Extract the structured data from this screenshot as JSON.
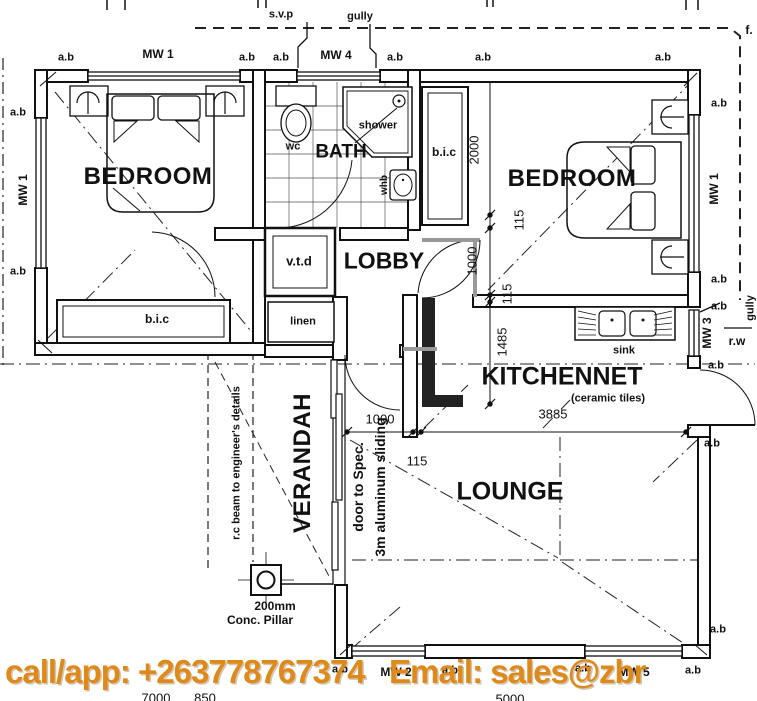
{
  "plan": {
    "rooms": {
      "bedroom_left": "BEDROOM",
      "bedroom_right": "BEDROOM",
      "bath": "BATH",
      "lobby": "LOBBY",
      "kitchennet": "KITCHENNET",
      "kitchennet_note": "(ceramic tiles)",
      "lounge": "LOUNGE",
      "verandah": "VERANDAH"
    },
    "fixtures": {
      "wc": "wc",
      "shower": "shower",
      "whb": "whb",
      "sink": "sink",
      "vtd": "v.t.d",
      "linen": "linen",
      "bic": "b.i.c"
    },
    "windows": {
      "mw1": "MW 1",
      "mw2": "MW 2",
      "mw3": "MW 3",
      "mw4": "MW 4",
      "mw5": "MW 5",
      "ab": "a.b"
    },
    "annotations": {
      "svp": "s.v.p",
      "gully": "gully",
      "f": "f.",
      "rw": "r.w",
      "rc_beam": "r.c beam to engineer's details",
      "pillar_size": "200mm",
      "pillar_type": "Conc. Pillar",
      "sliding_line1": "door to Spec.",
      "sliding_line2": "3m aluminum sliding"
    },
    "dimensions": {
      "d2000": "2000",
      "d115": "115",
      "d1000": "1000",
      "d1485": "1485",
      "d3885": "3885",
      "d7000": "7000",
      "d850": "850",
      "d5000": "5000"
    }
  },
  "banner": {
    "text": "call/app: +263778767374   Email: sales@zbr",
    "color": "#DE8A1B"
  }
}
